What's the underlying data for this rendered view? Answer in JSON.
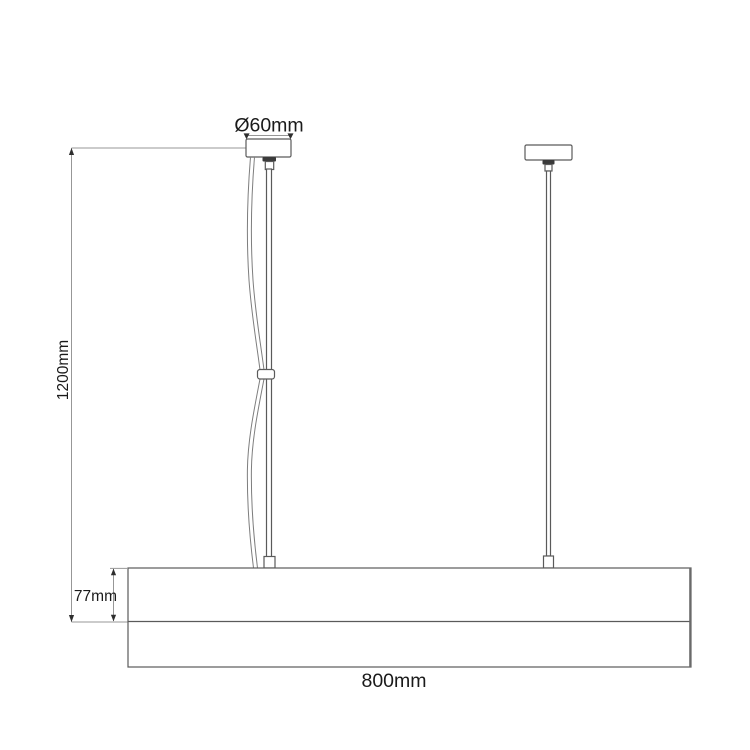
{
  "drawing": {
    "title": "Pendant lamp dimension drawing",
    "labels": {
      "canopy_diameter": "Ø60mm",
      "suspension_length": "1200mm",
      "body_height": "77mm",
      "body_width": "800mm"
    },
    "colors": {
      "outline": "#5a5a5a",
      "dimension_line": "#979797",
      "cord": "#7d7d7d",
      "grip_dark": "#3a3a3a",
      "text": "#1a1a1a",
      "background": "#ffffff"
    }
  }
}
